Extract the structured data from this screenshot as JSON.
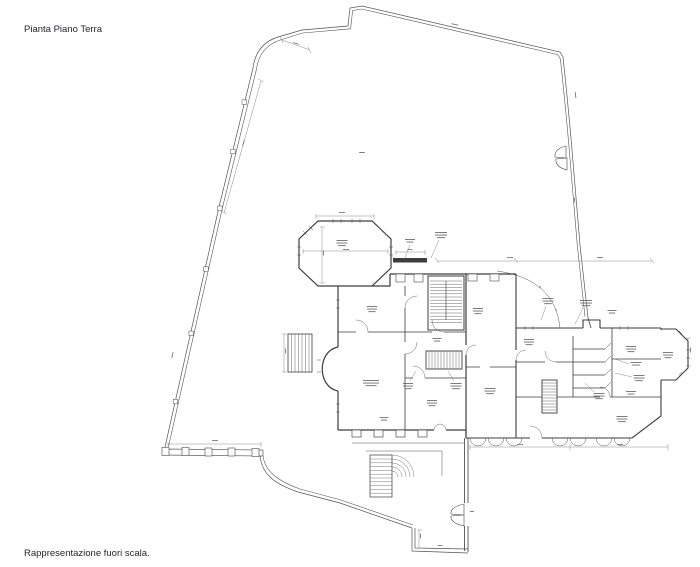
{
  "page": {
    "title": "Pianta Piano Terra",
    "footnote": "Rappresentazione fuori scala."
  },
  "colors": {
    "background": "#ffffff",
    "wall": "#3d3d3d",
    "detail": "#555555",
    "dimension": "#8a8a8a",
    "microtext": "#6e6e6e",
    "text": "#26262b"
  },
  "plan": {
    "micro_labels": [
      {
        "x": 342,
        "y": 240,
        "lines": 3,
        "w": 11
      },
      {
        "x": 410,
        "y": 239,
        "lines": 2,
        "w": 10,
        "leader": [
          410,
          245,
          404,
          260
        ]
      },
      {
        "x": 441,
        "y": 232,
        "lines": 3,
        "w": 12,
        "leader": [
          439,
          240,
          431,
          258
        ]
      },
      {
        "x": 372,
        "y": 306,
        "lines": 3,
        "w": 10
      },
      {
        "x": 371,
        "y": 380,
        "lines": 3,
        "w": 16
      },
      {
        "x": 384,
        "y": 417,
        "lines": 2,
        "w": 9
      },
      {
        "x": 432,
        "y": 400,
        "lines": 3,
        "w": 10
      },
      {
        "x": 408,
        "y": 383,
        "lines": 3,
        "w": 10,
        "leader": [
          410,
          381,
          416,
          371
        ]
      },
      {
        "x": 456,
        "y": 383,
        "lines": 3,
        "w": 11,
        "leader": [
          454,
          381,
          448,
          371
        ]
      },
      {
        "x": 478,
        "y": 308,
        "lines": 3,
        "w": 10
      },
      {
        "x": 437,
        "y": 338,
        "lines": 2,
        "w": 9
      },
      {
        "x": 490,
        "y": 388,
        "lines": 3,
        "w": 11
      },
      {
        "x": 529,
        "y": 339,
        "lines": 3,
        "w": 10
      },
      {
        "x": 548,
        "y": 298,
        "lines": 3,
        "w": 11,
        "leader": [
          546,
          306,
          541,
          320
        ]
      },
      {
        "x": 586,
        "y": 300,
        "lines": 3,
        "w": 12,
        "leader": [
          583,
          308,
          575,
          324
        ]
      },
      {
        "x": 612,
        "y": 310,
        "lines": 2,
        "w": 9
      },
      {
        "x": 631,
        "y": 346,
        "lines": 3,
        "w": 10
      },
      {
        "x": 636,
        "y": 362,
        "lines": 2,
        "w": 11,
        "leader": [
          629,
          364,
          615,
          359
        ]
      },
      {
        "x": 639,
        "y": 375,
        "lines": 3,
        "w": 11,
        "leader": [
          632,
          377,
          615,
          373
        ]
      },
      {
        "x": 631,
        "y": 391,
        "lines": 2,
        "w": 10
      },
      {
        "x": 599,
        "y": 393,
        "lines": 3,
        "w": 11,
        "leader": [
          594,
          392,
          585,
          383
        ]
      },
      {
        "x": 622,
        "y": 416,
        "lines": 3,
        "w": 11
      },
      {
        "x": 668,
        "y": 352,
        "lines": 3,
        "w": 10
      },
      {
        "x": 362,
        "y": 152,
        "lines": 1,
        "w": 8
      }
    ],
    "dim_marks": [
      {
        "x": 342,
        "y": 212,
        "w": 6,
        "rot": 0
      },
      {
        "x": 346,
        "y": 249,
        "w": 6,
        "rot": 0
      },
      {
        "x": 323,
        "y": 253,
        "w": 5,
        "rot": -90
      },
      {
        "x": 243,
        "y": 143,
        "w": 6,
        "rot": -75
      },
      {
        "x": 172,
        "y": 355,
        "w": 6,
        "rot": -77
      },
      {
        "x": 296,
        "y": 43,
        "w": 6,
        "rot": 18
      },
      {
        "x": 455,
        "y": 24,
        "w": 7,
        "rot": 13
      },
      {
        "x": 576,
        "y": 95,
        "w": 6,
        "rot": 84
      },
      {
        "x": 575,
        "y": 200,
        "w": 5,
        "rot": 85
      },
      {
        "x": 215,
        "y": 440,
        "w": 6,
        "rot": 0
      },
      {
        "x": 410,
        "y": 249,
        "w": 5,
        "rot": 0
      },
      {
        "x": 510,
        "y": 257,
        "w": 6,
        "rot": 0
      },
      {
        "x": 600,
        "y": 257,
        "w": 6,
        "rot": 0
      },
      {
        "x": 691,
        "y": 350,
        "w": 5,
        "rot": 90
      },
      {
        "x": 421,
        "y": 536,
        "w": 5,
        "rot": 90
      },
      {
        "x": 440,
        "y": 545,
        "w": 5,
        "rot": 0
      },
      {
        "x": 472,
        "y": 511,
        "w": 4,
        "rot": 0
      },
      {
        "x": 520,
        "y": 444,
        "w": 6,
        "rot": 0
      },
      {
        "x": 620,
        "y": 444,
        "w": 6,
        "rot": 0
      },
      {
        "x": 285,
        "y": 351,
        "w": 5,
        "rot": -90
      }
    ]
  }
}
